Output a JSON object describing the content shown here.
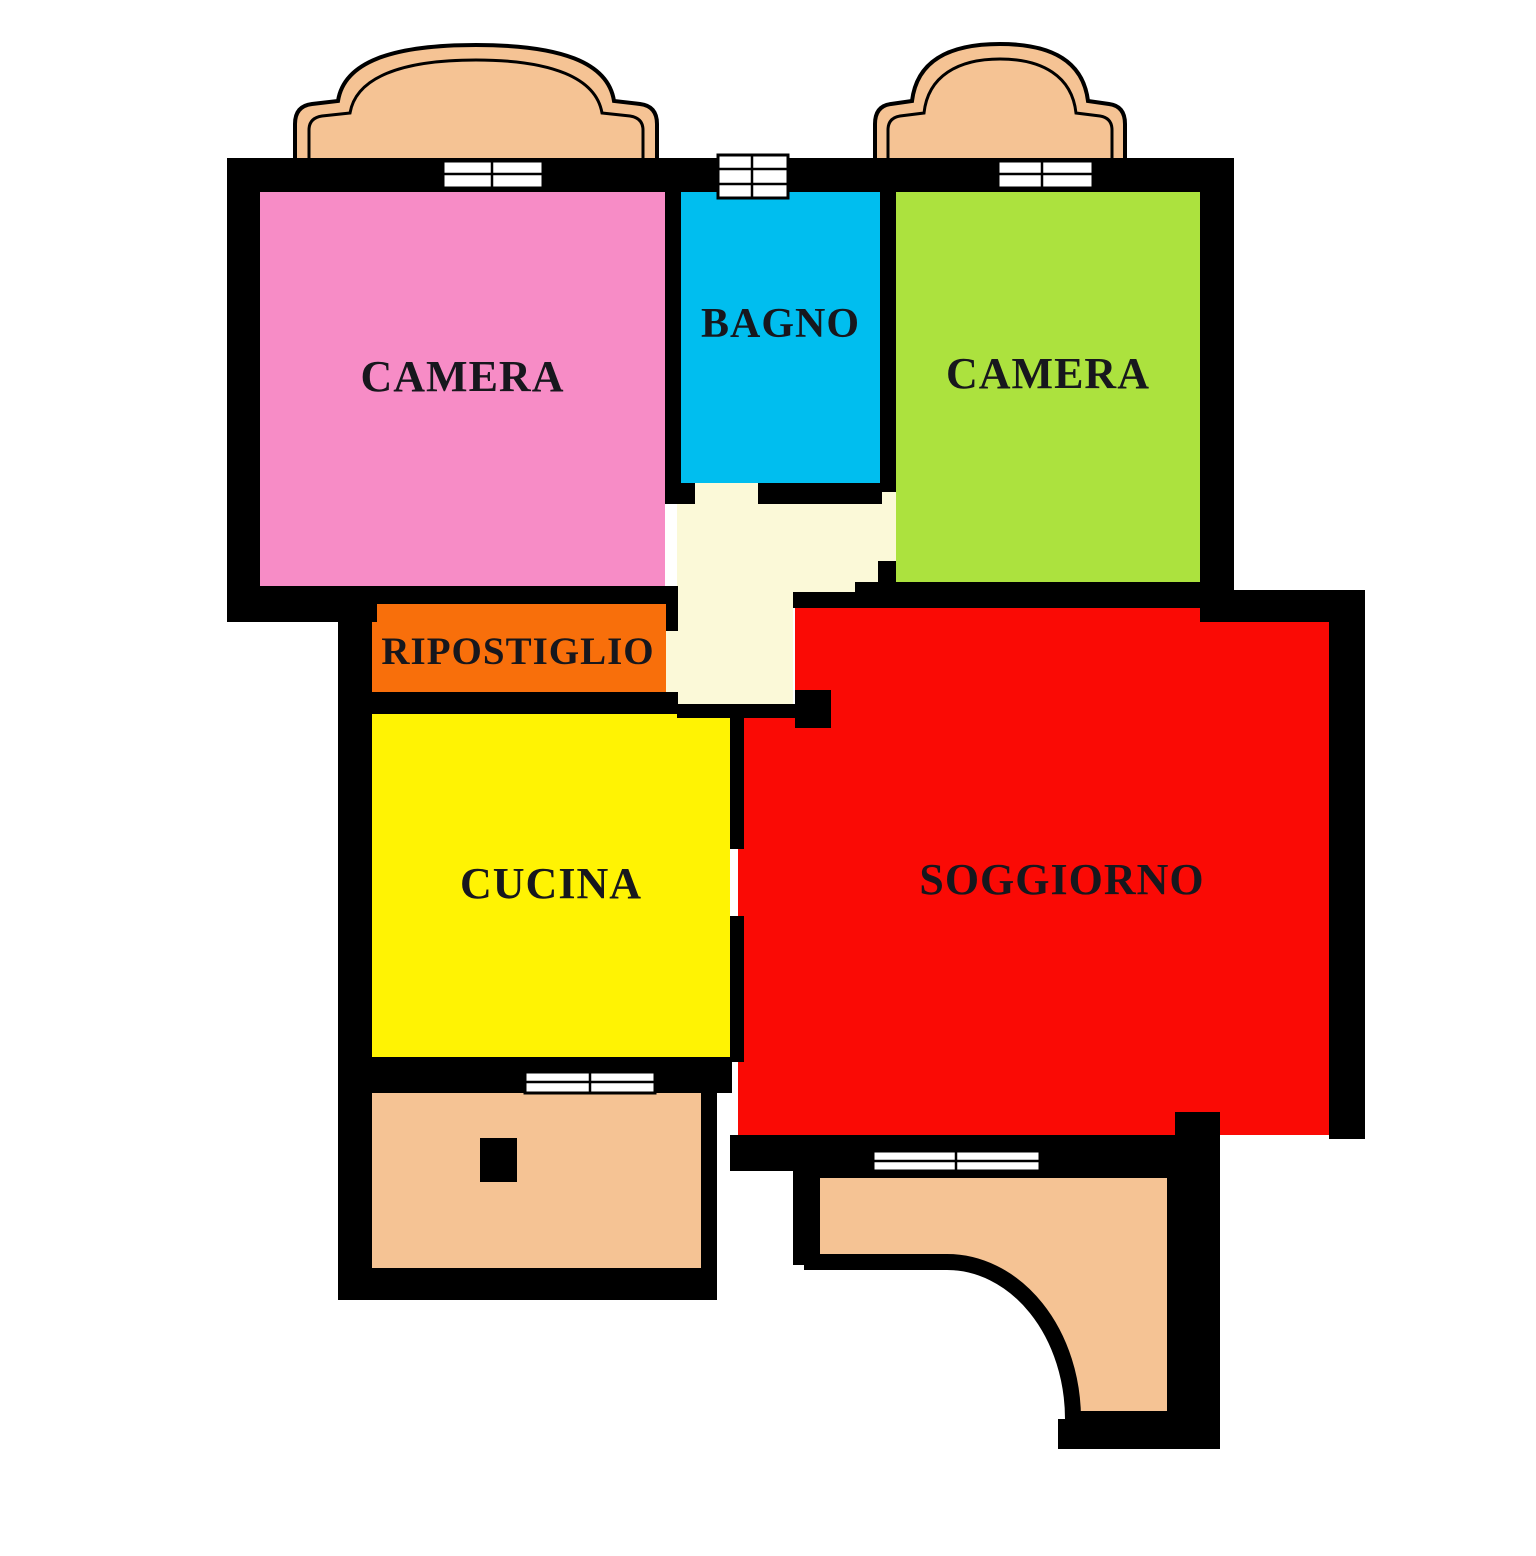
{
  "plan": {
    "type": "apartment-floor-plan",
    "rooms": {
      "camera_left": {
        "label": "CAMERA",
        "color": "#f78cc6"
      },
      "bagno": {
        "label": "BAGNO",
        "color": "#00beef"
      },
      "camera_right": {
        "label": "CAMERA",
        "color": "#ace23e"
      },
      "ripostiglio": {
        "label": "RIPOSTIGLIO",
        "color": "#f86f0b"
      },
      "cucina": {
        "label": "CUCINA",
        "color": "#fff303"
      },
      "soggiorno": {
        "label": "SOGGIORNO",
        "color": "#fa0a05"
      },
      "hallway": {
        "color": "#fbf9d8"
      }
    },
    "balconies": {
      "count": 4,
      "color": "#f5c394"
    },
    "palette": {
      "wall": "#000000",
      "window": "#ffffff",
      "background": "#ffffff",
      "text": "#17171d"
    }
  }
}
